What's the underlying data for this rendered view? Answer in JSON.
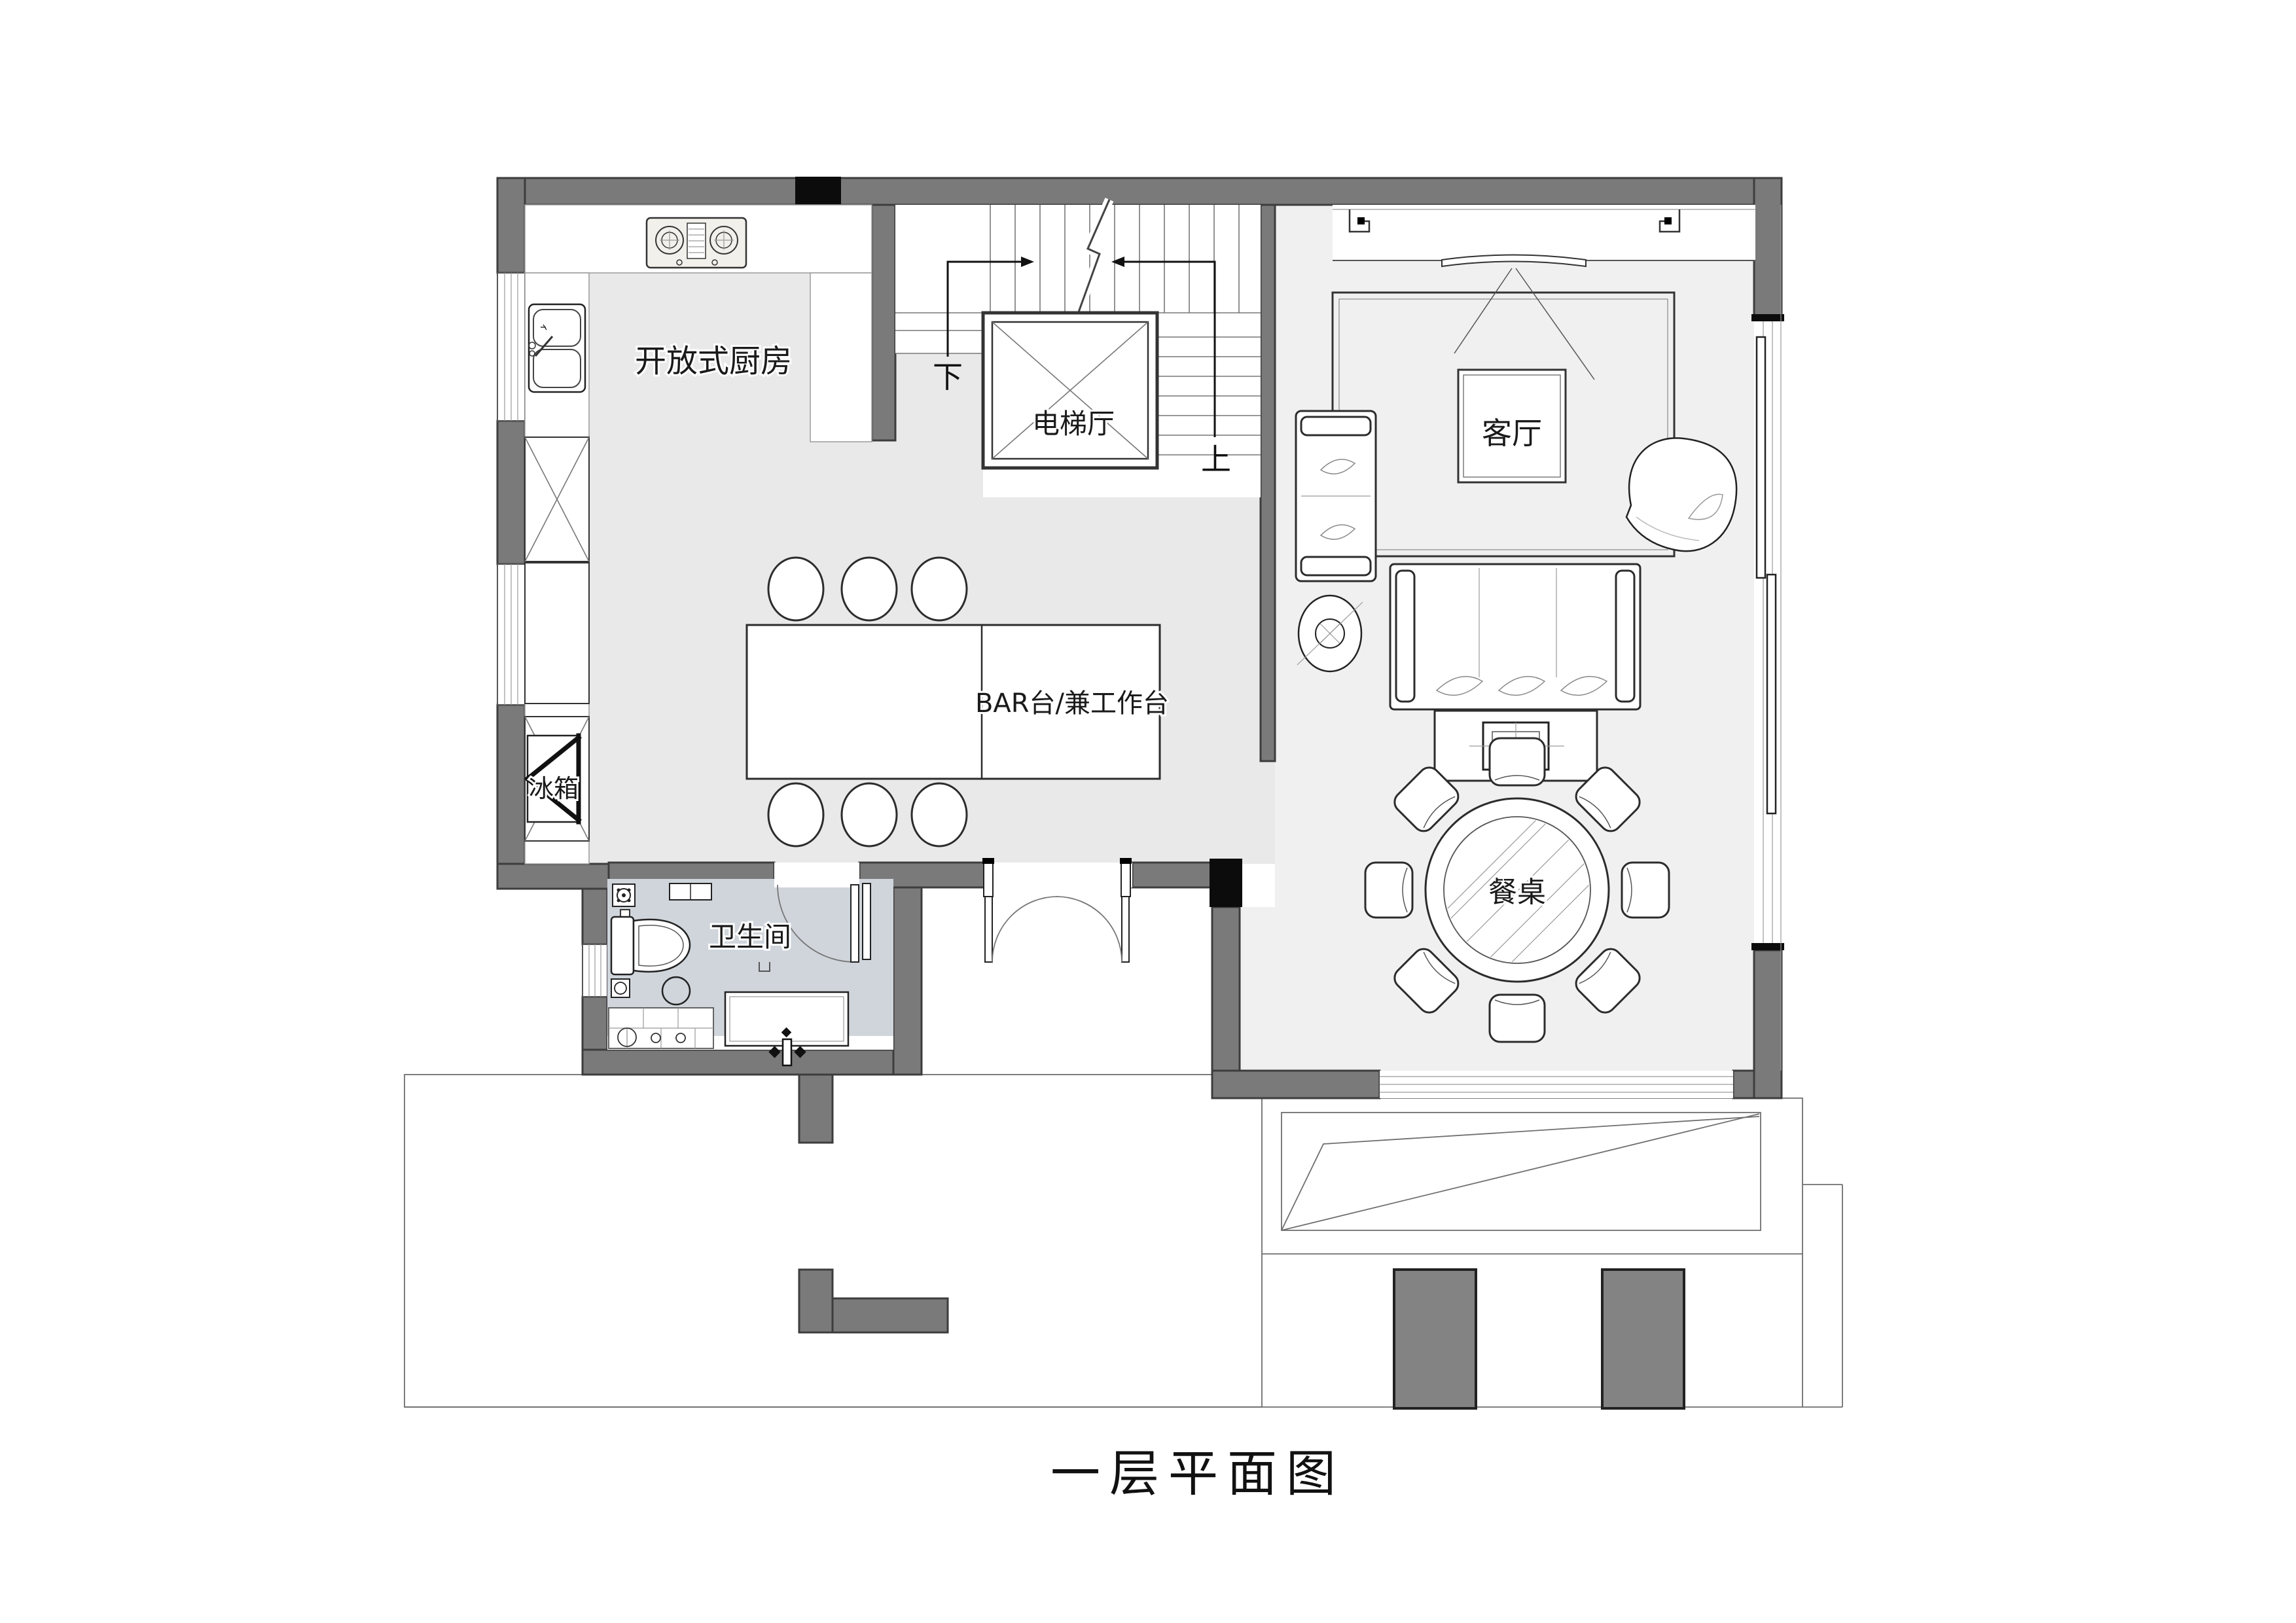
{
  "title": "一层平面图",
  "labels": {
    "kitchen": "开放式厨房",
    "elevator_hall": "电梯厅",
    "living_room": "客厅",
    "bar_counter": "BAR台/兼工作台",
    "fridge": "冰箱",
    "bathroom": "卫生间",
    "dining_table": "餐桌",
    "stairs_down": "下",
    "stairs_up": "上"
  },
  "colors": {
    "wall": "#7a7a7a",
    "wall_outline": "#3d3d3d",
    "column": "#0c0c0c",
    "floor_main": "#e9e9e9",
    "floor_living": "#f0f0f0",
    "floor_bathroom": "#cfd5db",
    "planter": "#838383",
    "line": "#4a4a4a",
    "ink": "#1a1a1a"
  }
}
